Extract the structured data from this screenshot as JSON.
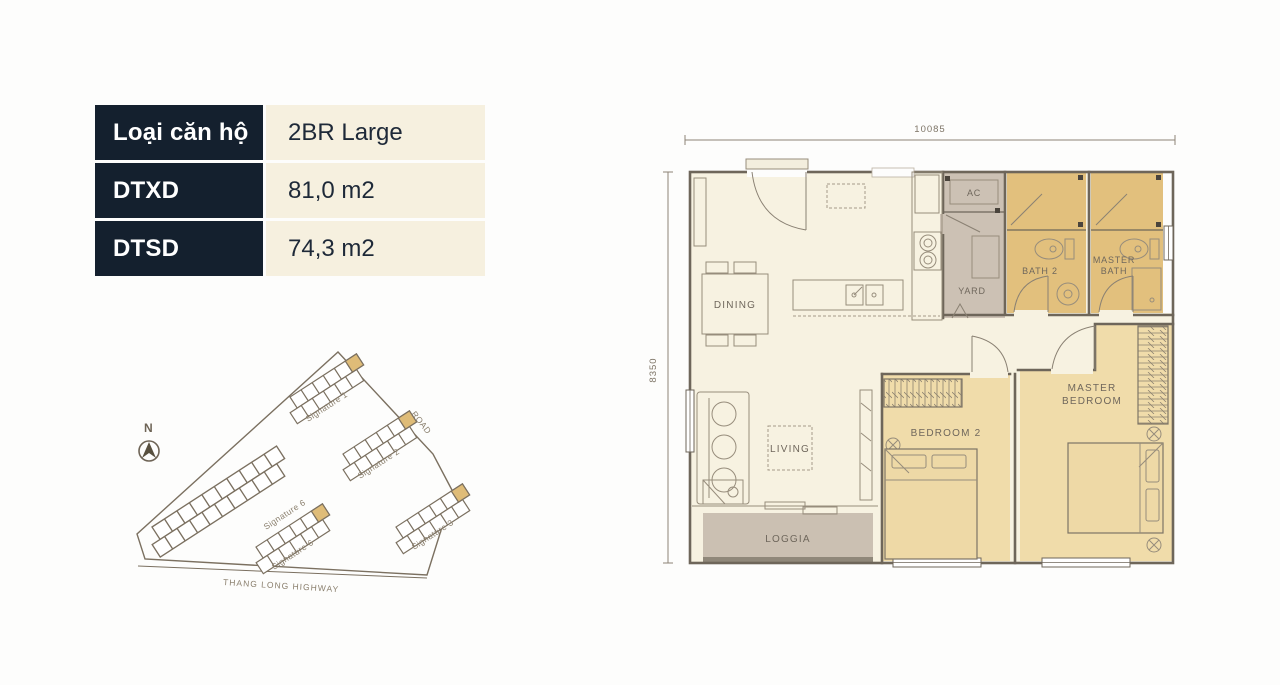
{
  "info_table": {
    "rows": [
      {
        "label": "Loại căn hộ",
        "value": "2BR Large"
      },
      {
        "label": "DTXD",
        "value": "81,0 m2"
      },
      {
        "label": "DTSD",
        "value": "74,3 m2"
      }
    ]
  },
  "site_map": {
    "compass": "N",
    "road": "ROAD",
    "highway": "THANG LONG HIGHWAY",
    "buildings": [
      "Signature 1",
      "Signature 2",
      "Signature 3",
      "Signature 5",
      "Signature 6"
    ]
  },
  "floor_plan": {
    "dim_top": "10085",
    "dim_left": "8350",
    "rooms": {
      "dining": "DINING",
      "living": "LIVING",
      "loggia": "LOGGIA",
      "ac": "AC",
      "yard": "YARD",
      "bath2": "BATH 2",
      "master_bath_1": "MASTER",
      "master_bath_2": "BATH",
      "bedroom2": "BEDROOM 2",
      "master_bedroom_1": "MASTER",
      "master_bedroom_2": "BEDROOM"
    }
  },
  "colors": {
    "table_header_bg": "#14202e",
    "cream": "#f6f0df",
    "plan_floor": "#f7f2e1",
    "bath_gold": "#e2c07d",
    "bedroom_gold": "#f0dcaa",
    "utility_gray": "#ccc1b4",
    "loggia_band": "#90887a",
    "wall_line": "#6e665a",
    "map_line": "#7b7060"
  }
}
